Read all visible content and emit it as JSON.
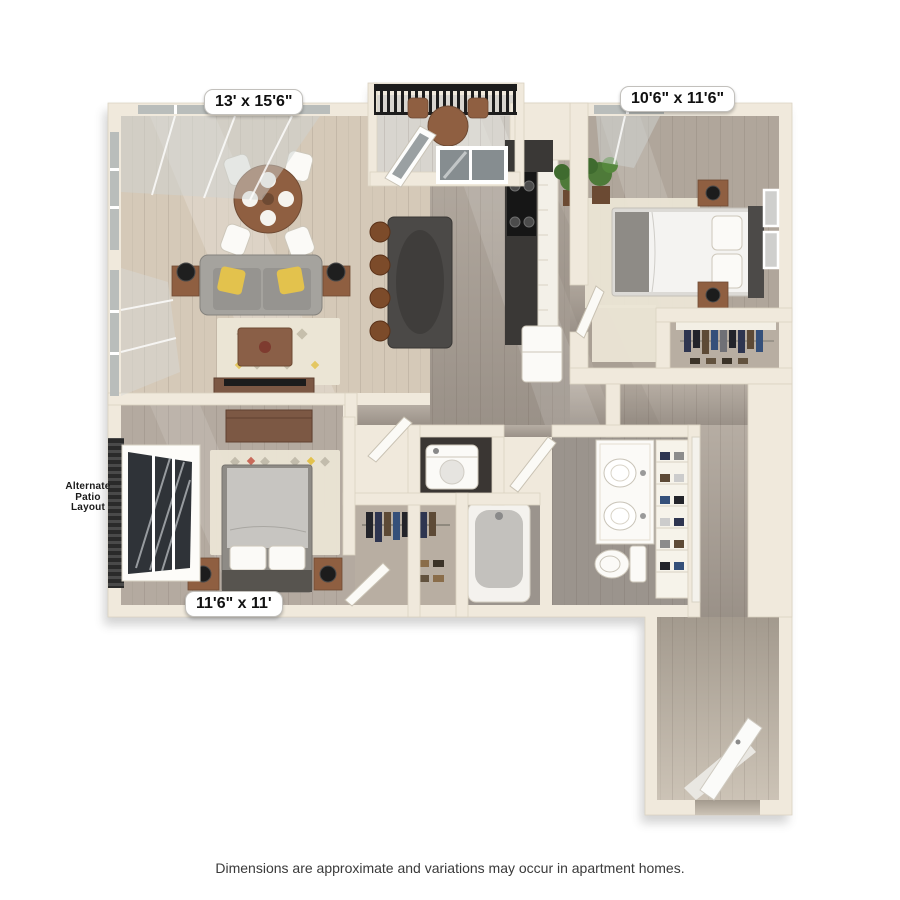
{
  "window": {
    "width": 900,
    "height": 900,
    "background": "#ffffff"
  },
  "floor_plan": {
    "kind": "3d-apartment-floor-plan",
    "room_labels": {
      "living_dining": "13' x 15'6\"",
      "bedroom_primary": "10'6\" x 11'6\"",
      "bedroom_second": "11'6\" x 11'"
    },
    "annotations": {
      "alternate_patio": "Alternate\nPatio\nLayout"
    },
    "disclaimer": "Dimensions are approximate and variations may occur in apartment homes."
  },
  "colors": {
    "pageBg": "#ffffff",
    "wall": "#f0e9dc",
    "wallEdge": "#dad2c1",
    "floorLiving": "#d5c9b8",
    "floorHallTop": "#b6ada3",
    "floorHallBottom": "#9a9188",
    "floorBed1": "#b0a69b",
    "floorBed2": "#b4aaa0",
    "floorBath": "#9b948d",
    "floorCloset": "#b8aea2",
    "floorCorrTop": "#a39a8e",
    "floorCorrBottom": "#ccc3b6",
    "floorBalcony": "#d8d5cf",
    "floorLaundry": "#3a3633",
    "railing": "#1d1d1d",
    "glass": "#b9bdbb",
    "glassDark": "#2f3338",
    "island": "#4b4947",
    "islandShade": "#3f3d3b",
    "stool": "#7c4b2a",
    "sofa": "#969490",
    "sofaLight": "#a5a39e",
    "pillowYellow": "#e3c24d",
    "woodBrown": "#8f5f41",
    "woodDark": "#6e4a33",
    "rug": "#ebe5d5",
    "bedWhite": "#f4f3f1",
    "bedGray": "#c7c5c1",
    "headboard": "#4c4a48",
    "throwGray": "#8e8b86",
    "plantGreen": "#4e7a39",
    "clothesNavy": "#2e3550",
    "clothesDark": "#23242a",
    "clothesBrown": "#5d4a36",
    "labelBg": "#ffffff",
    "labelBorder": "#c2c0bc",
    "labelText": "#111111",
    "annotationText": "#1a1a1a",
    "disclaimerText": "#3a3a3a"
  }
}
